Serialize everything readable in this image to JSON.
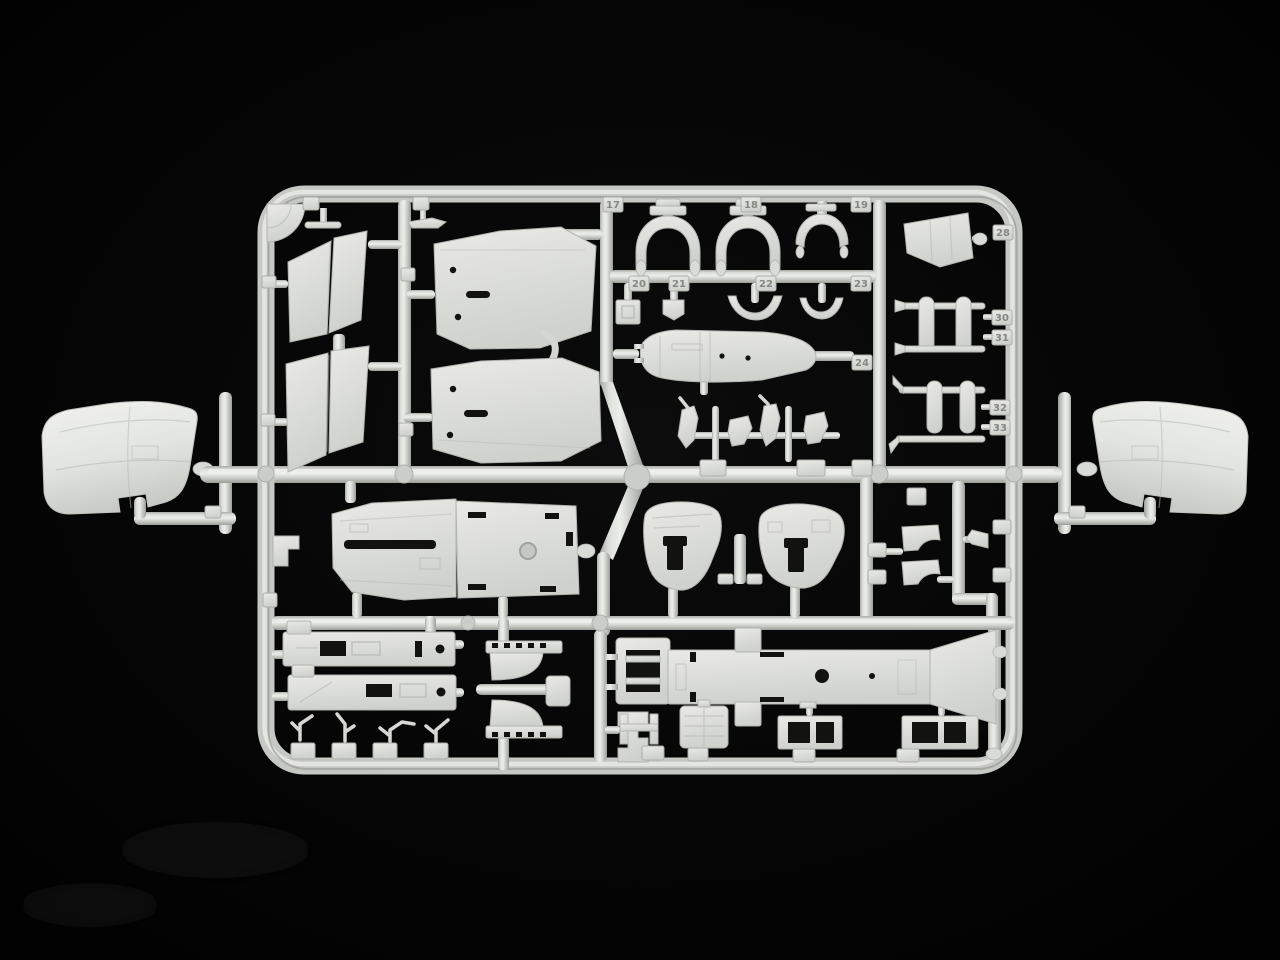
{
  "scene": {
    "type": "photograph",
    "subject": "injection-moulded plastic model kit sprue (parts tree)",
    "description": "Light grey styrene runner frame holding unassembled scale-model aircraft parts on a black background; two large curved fuselage panels attach outside the frame on the left and right sides.",
    "background_color": "#050505",
    "plastic_base_color": "#d8dad5",
    "plastic_highlight_color": "#eef0ec",
    "plastic_shadow_color": "#9b9d97"
  },
  "part_tags": [
    {
      "number": "17"
    },
    {
      "number": "18"
    },
    {
      "number": "19"
    },
    {
      "number": "20"
    },
    {
      "number": "21"
    },
    {
      "number": "22"
    },
    {
      "number": "23"
    },
    {
      "number": "24"
    },
    {
      "number": "28"
    },
    {
      "number": "30"
    },
    {
      "number": "31"
    },
    {
      "number": "32"
    },
    {
      "number": "33"
    }
  ],
  "part_groups": {
    "left_outer": "large curved fuselage panel",
    "right_outer": "large curved fuselage panel mirrored",
    "top_left": "angled hull panels",
    "top_center": "large deck panels with holes",
    "top_middle": "cockpit formers, crescents and fuselage spine",
    "top_right": "intake cone and undercarriage frames",
    "middle": "cockpit tub, instrument panels and fittings",
    "bottom": "side consoles, intake lips, ventral keel and small fittings"
  }
}
